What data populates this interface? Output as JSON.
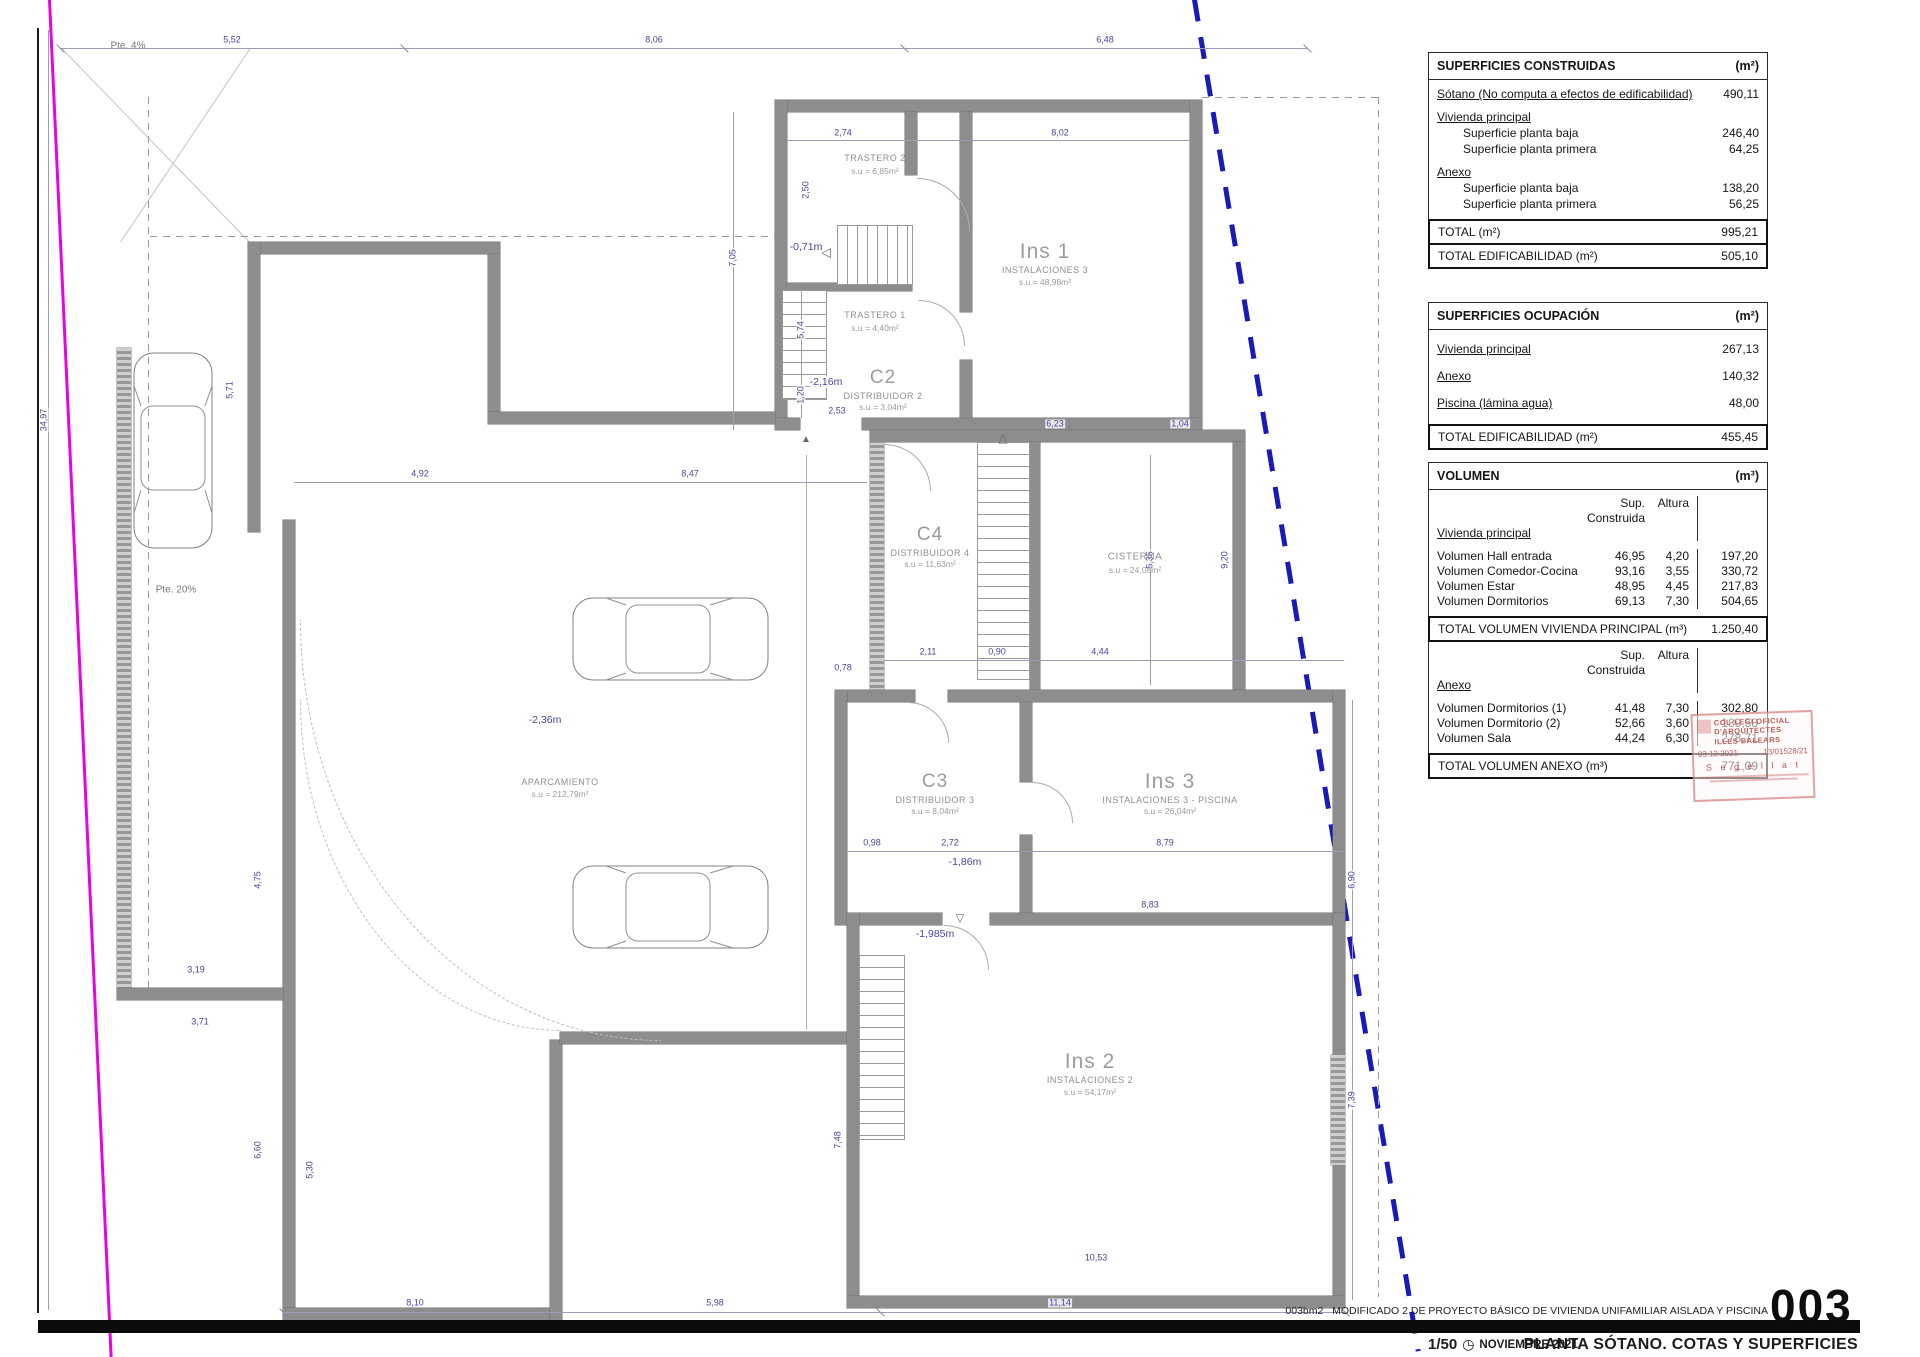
{
  "plan": {
    "slope_top": "Pte. 4%",
    "slope_drive": "Pte. 20%",
    "rooms": [
      {
        "n": "TRASTERO 2",
        "a": "s.u = 6,85m²"
      },
      {
        "n": "TRASTERO 1",
        "a": "s.u = 4,40m²"
      },
      {
        "c": "Ins 1",
        "n": "INSTALACIONES 3",
        "a": "s.u = 48,98m²"
      },
      {
        "c": "C2",
        "n": "DISTRIBUIDOR 2",
        "a": "s.u = 3,04m²"
      },
      {
        "c": "C4",
        "n": "DISTRIBUIDOR 4",
        "a": "s.u = 11,63m²"
      },
      {
        "n": "CISTERNA",
        "a": "s.u = 24,08m²"
      },
      {
        "c": "C3",
        "n": "DISTRIBUIDOR 3",
        "a": "s.u = 8,04m²"
      },
      {
        "c": "Ins 3",
        "n": "INSTALACIONES 3 - PISCINA",
        "a": "s.u = 26,04m²"
      },
      {
        "c": "Ins 2",
        "n": "INSTALACIONES 2",
        "a": "s.u = 54,17m²"
      },
      {
        "n": "APARCAMIENTO",
        "a": "s.u = 212,79m²"
      }
    ],
    "elev": [
      "-0,71m",
      "-2,16m",
      "-2,36m",
      "-1,86m",
      "-1,985m"
    ],
    "dims": [
      "5,52",
      "8,06",
      "6,48",
      "2,74",
      "8,02",
      "2,50",
      "7,05",
      "5,74",
      "1,20",
      "2,53",
      "6,23",
      "1,04",
      "4,92",
      "8,47",
      "5,35",
      "4,44",
      "9,20",
      "0,78",
      "2,11",
      "0,90",
      "0,98",
      "2,72",
      "8,79",
      "6,90",
      "8,83",
      "7,48",
      "7,39",
      "10,53",
      "5,30",
      "6,60",
      "4,75",
      "5,71",
      "3,19",
      "3,71",
      "34,97",
      "8,10",
      "5,98",
      "11,14"
    ]
  },
  "icons": {
    "clock": "◷",
    "arrow_up": "▲",
    "arrow_down": "▽",
    "arrow_left": "◁",
    "arrow_up_open": "△"
  },
  "tables": {
    "t1": {
      "title": "SUPERFICIES CONSTRUIDAS",
      "unit": "(m²)",
      "r0l": "Sótano (No computa a efectos de edificabilidad)",
      "r0v": "490,11",
      "g1": "Vivienda principal",
      "r1l": "Superficie planta baja",
      "r1v": "246,40",
      "r2l": "Superficie planta primera",
      "r2v": "64,25",
      "g2": "Anexo",
      "r3l": "Superficie planta baja",
      "r3v": "138,20",
      "r4l": "Superficie planta primera",
      "r4v": "56,25",
      "totl": "TOTAL  (m²)",
      "totv": "995,21",
      "edifl": "TOTAL EDIFICABILIDAD (m²)",
      "edifv": "505,10"
    },
    "t2": {
      "title": "SUPERFICIES OCUPACIÓN",
      "unit": "(m²)",
      "r0l": "Vivienda principal",
      "r0v": "267,13",
      "r1l": "Anexo",
      "r1v": "140,32",
      "r2l": "Piscina (lámina agua)",
      "r2v": "48,00",
      "totl": "TOTAL EDIFICABILIDAD (m²)",
      "totv": "455,45"
    },
    "t3": {
      "title": "VOLUMEN",
      "unit": "(m³)",
      "colsup": "Sup. Construida",
      "colalt": "Altura",
      "g1": "Vivienda principal",
      "r0l": "Volumen Hall entrada",
      "r0s": "46,95",
      "r0a": "4,20",
      "r0t": "197,20",
      "r1l": "Volumen Comedor-Cocina",
      "r1s": "93,16",
      "r1a": "3,55",
      "r1t": "330,72",
      "r2l": "Volumen Estar",
      "r2s": "48,95",
      "r2a": "4,45",
      "r2t": "217,83",
      "r3l": "Volumen Dormitorios",
      "r3s": "69,13",
      "r3a": "7,30",
      "r3t": "504,65",
      "tot1l": "TOTAL VOLUMEN VIVIENDA PRINCIPAL (m³)",
      "tot1v": "1.250,40",
      "colsup2": "Sup. Construida",
      "colalt2": "Altura",
      "g2": "Anexo",
      "r4l": "Volumen Dormitorios (1)",
      "r4s": "41,48",
      "r4a": "7,30",
      "r4t": "302,80",
      "r5l": "Volumen Dormitorio (2)",
      "r5s": "52,66",
      "r5a": "3,60",
      "r5t": "189,58",
      "r6l": "Volumen Sala",
      "r6s": "44,24",
      "r6a": "6,30",
      "r6t": "278,71",
      "tot2l": "TOTAL VOLUMEN ANEXO (m³)",
      "tot2v": "771,09"
    }
  },
  "stamp": {
    "line1": "COL·LEGI OFICIAL",
    "line2": "D'ARQUITECTES",
    "line3": "ILLES BALEARS",
    "date": "03.12.2021",
    "num": "13/01528/21",
    "seal": "S e g e l l a t"
  },
  "titleblock": {
    "code_small": "003bm2",
    "project": "MODIFICADO 2 DE PROYECTO BÁSICO DE VIVIENDA UNIFAMILIAR AISLADA Y PISCINA",
    "sheet_no": "003",
    "scale": "1/50",
    "date": "NOVIEMBRE 2021",
    "sheet_title": "PLANTA SÓTANO. COTAS Y SUPERFICIES"
  }
}
